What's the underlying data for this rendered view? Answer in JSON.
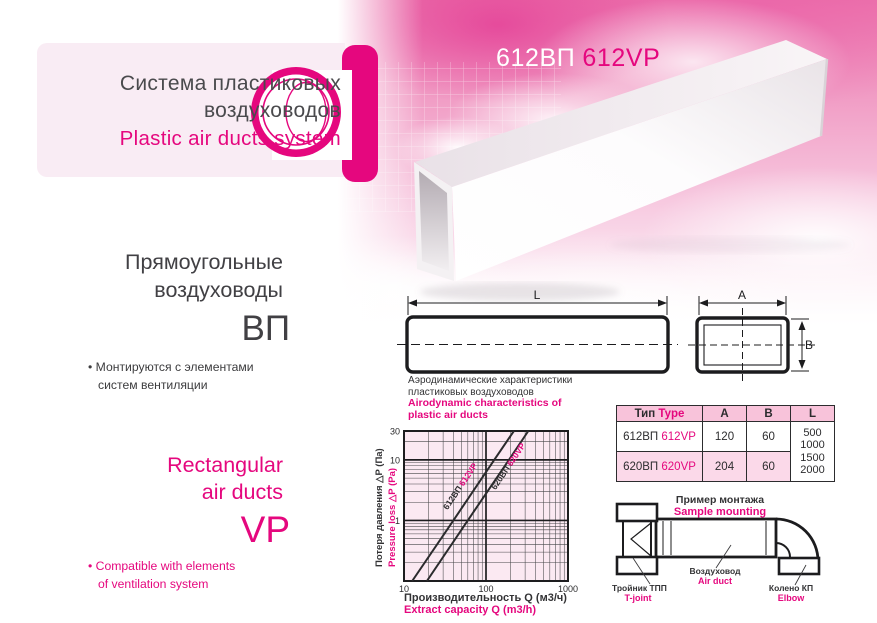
{
  "colors": {
    "accent": "#e5077e",
    "dark_text": "#3f3f41",
    "table_header_bg": "#f8c3da",
    "table_alt_row_bg": "#fbd9e9",
    "chart_bg": "#fbe9f2"
  },
  "header": {
    "title_ru_line1": "Система пластиковых",
    "title_ru_line2": "воздуховодов",
    "title_en": "Plastic air ducts system"
  },
  "product": {
    "code_ru": "612ВП",
    "code_en": "612VP"
  },
  "intro_ru": {
    "heading_line1": "Прямоугольные",
    "heading_line2": "воздуховоды",
    "code": "ВП",
    "bullet_glyph": "•",
    "bullet_line1": "Монтируются с элементами",
    "bullet_line2": "систем вентиляции"
  },
  "intro_en": {
    "heading_line1": "Rectangular",
    "heading_line2": "air ducts",
    "code": "VP",
    "bullet_glyph": "•",
    "bullet_line1": "Compatible with elements",
    "bullet_line2": "of ventilation system"
  },
  "drawing": {
    "dim_length": "L",
    "dim_width": "A",
    "dim_height": "B"
  },
  "chart": {
    "title_ru_line1": "Аэродинамические характеристики",
    "title_ru_line2": "пластиковых воздуховодов",
    "title_en_line1": "Airodynamic characteristics of",
    "title_en_line2": "plastic air ducts",
    "ylabel_ru": "Потеря давления △P (Па)",
    "ylabel_en": "Pressure loss △P (Pa)",
    "xlabel_ru": "Производительность Q (м3/ч)",
    "xlabel_en": "Extract capacity Q (m3/h)"
  },
  "chart_data": {
    "type": "line",
    "x_scale": "log",
    "y_scale": "log",
    "xlim": [
      10,
      1000
    ],
    "ylim": [
      0.1,
      30
    ],
    "x_ticks": [
      10,
      100,
      1000
    ],
    "y_ticks": [
      30,
      10,
      1
    ],
    "xlabel": "Производительность Q (м3/ч) / Extract capacity Q (m3/h)",
    "ylabel": "Потеря давления ΔP (Па) / Pressure loss ΔP (Pa)",
    "grid": "log major+minor, dark lines on pale pink",
    "legend_position": "labels rotated along lines",
    "series": [
      {
        "name_ru": "612ВП",
        "name_en": "612VP",
        "points": [
          [
            12.6,
            0.1
          ],
          [
            40,
            1
          ],
          [
            126,
            10
          ],
          [
            219,
            30
          ]
        ]
      },
      {
        "name_ru": "620ВП",
        "name_en": "620VP",
        "points": [
          [
            19,
            0.1
          ],
          [
            60,
            1
          ],
          [
            190,
            10
          ],
          [
            328,
            30
          ]
        ]
      }
    ]
  },
  "table": {
    "header": {
      "type_ru": "Тип",
      "type_en": "Type",
      "col_a": "A",
      "col_b": "B",
      "col_l": "L"
    },
    "rows": [
      {
        "code_ru": "612ВП",
        "code_en": "612VP",
        "a": "120",
        "b": "60"
      },
      {
        "code_ru": "620ВП",
        "code_en": "620VP",
        "a": "204",
        "b": "60"
      }
    ],
    "l_values": [
      "500",
      "1000",
      "1500",
      "2000"
    ]
  },
  "mounting": {
    "title_ru": "Пример монтажа",
    "title_en": "Sample mounting",
    "labels": {
      "tjoint_ru": "Тройник ТПП",
      "tjoint_en": "T-joint",
      "duct_ru": "Воздуховод",
      "duct_en": "Air duct",
      "elbow_ru": "Колено КП",
      "elbow_en": "Elbow"
    }
  }
}
